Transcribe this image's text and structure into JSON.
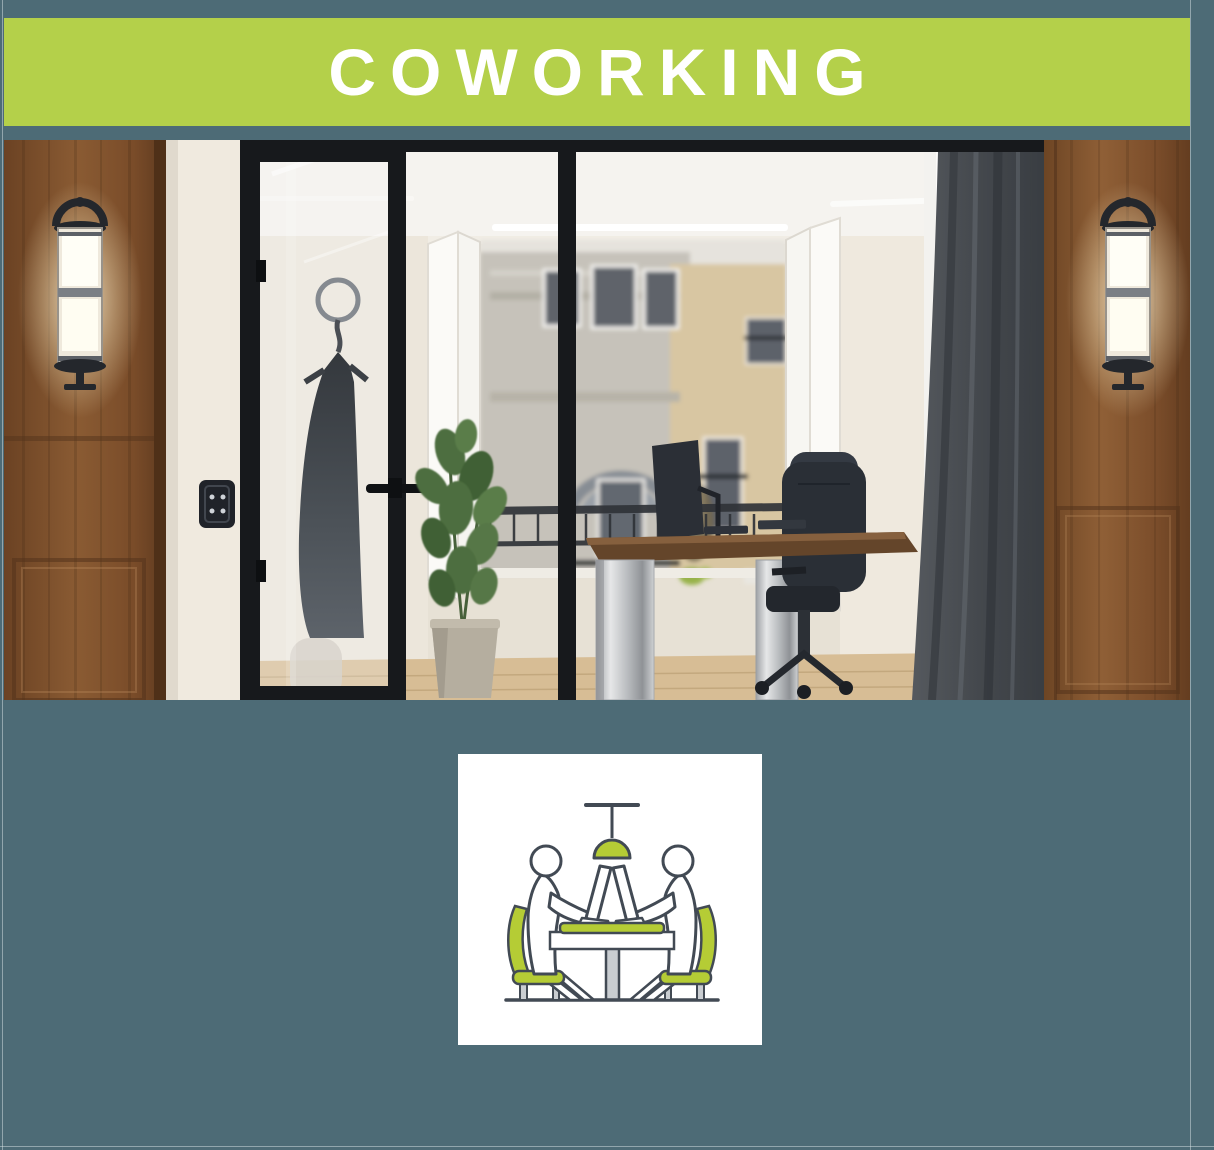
{
  "page": {
    "background_color": "#4d6b76"
  },
  "banner": {
    "title": "COWORKING",
    "background_color": "#b4d04a",
    "text_color": "#ffffff"
  },
  "photo": {
    "name": "coworking-office-interior-photo",
    "alt": "Office interior with wood panels, lit wall sconces, black-framed glass door, plant, desk with chair and a Paris building view"
  },
  "card": {
    "background_color": "#ffffff",
    "icon": "people-working-at-table-icon",
    "icon_accent_color": "#b5cc35",
    "icon_outline_color": "#424a54",
    "icon_metal_color": "#c9cdd1"
  }
}
